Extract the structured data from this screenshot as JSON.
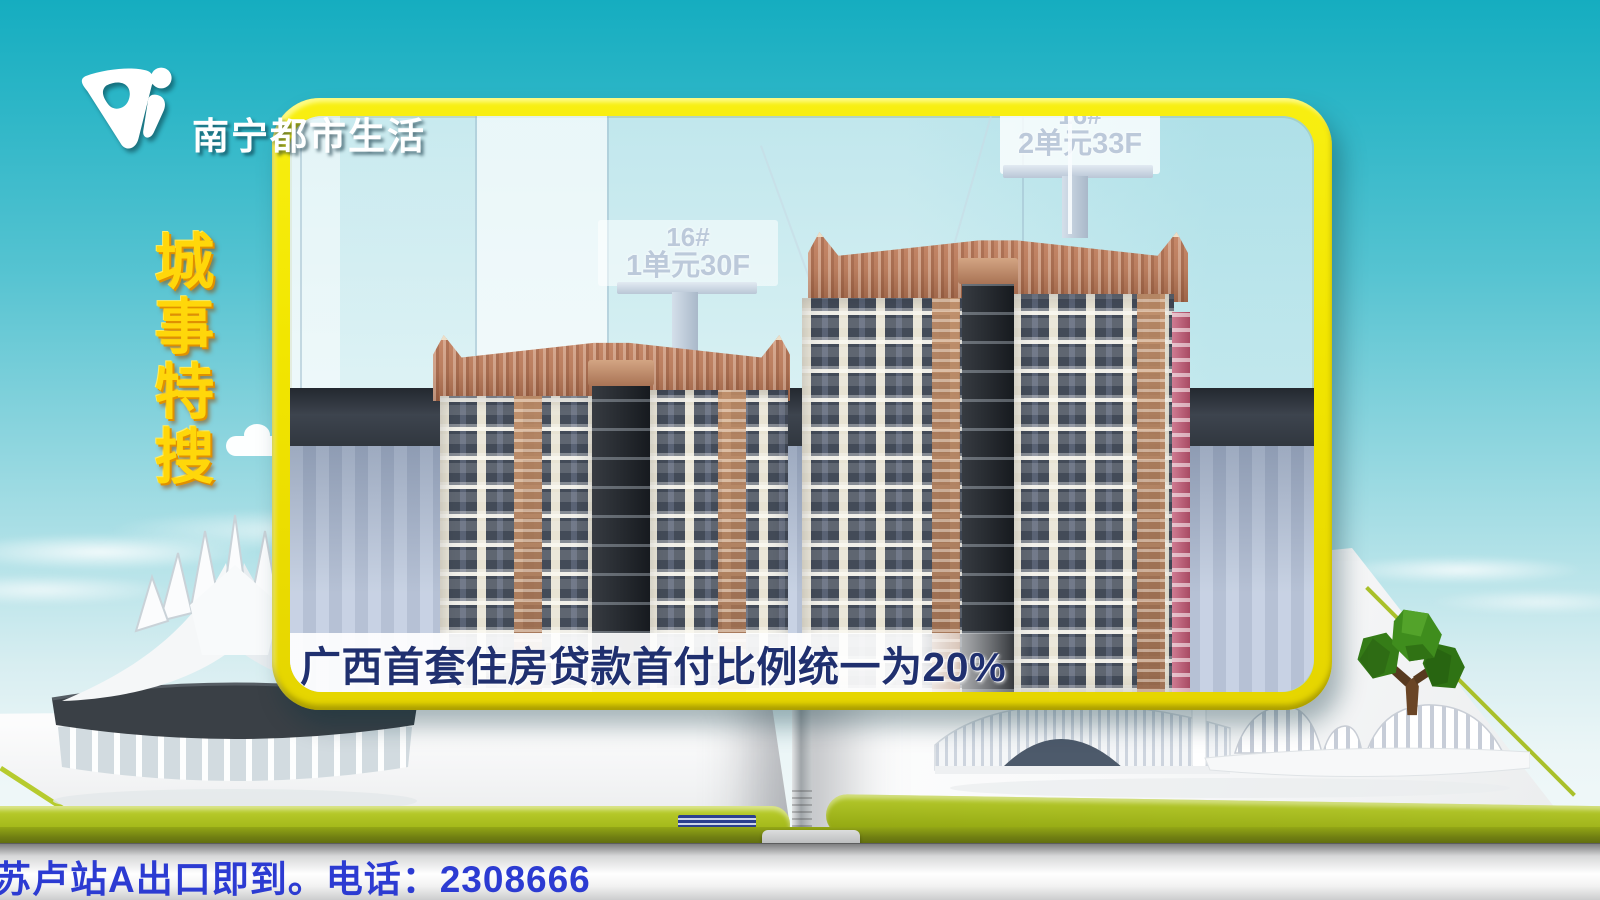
{
  "colors": {
    "frame_yellow": "#f2e600",
    "title_yellow": "#ffd70a",
    "caption_navy": "#20306f",
    "ticker_blue": "#2c3bd2",
    "book_green": "#a2b81a",
    "crown_bronze": "#b97d5e",
    "tower_dark": "#414958",
    "tower_cream": "#e9e4d4"
  },
  "channel": {
    "logo_name": "南宁都市生活"
  },
  "program": {
    "vertical_title": "城事特搜"
  },
  "video": {
    "signs": {
      "front": {
        "line1": "16#",
        "line2": "1单元30F"
      },
      "back": {
        "line1": "16#",
        "line2": "2单元33F"
      }
    },
    "caption": "广西首套住房贷款首付比例统一为20%"
  },
  "ticker": {
    "text": "苏卢站A出口即到。电话：2308666"
  }
}
